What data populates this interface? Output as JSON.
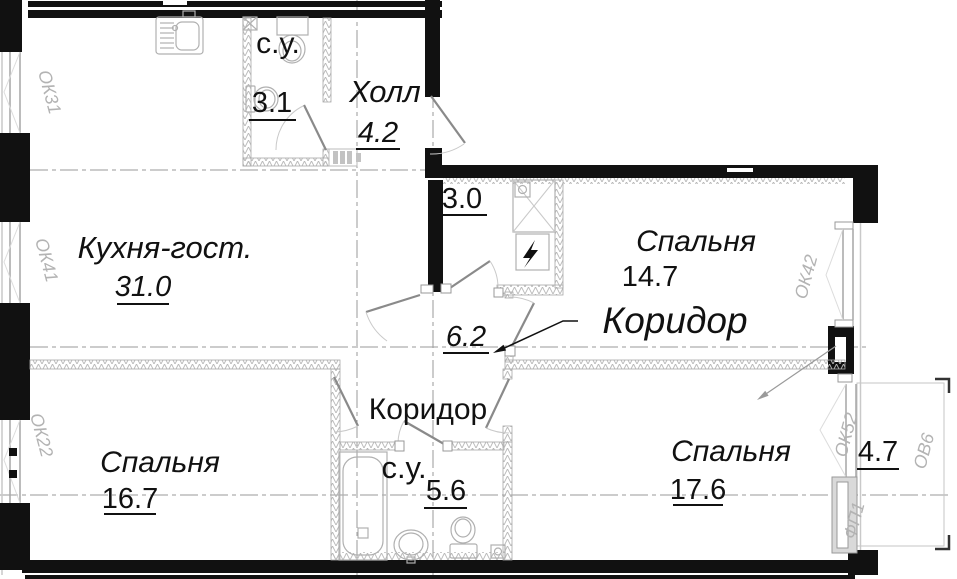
{
  "rooms": {
    "bath_top": {
      "name": "с.у.",
      "area": "3.1"
    },
    "hall": {
      "name": "Холл",
      "area": "4.2"
    },
    "kitchen_living": {
      "name": "Кухня-гост.",
      "area": "31.0"
    },
    "closet": {
      "area": "3.0"
    },
    "bedroom_top_right": {
      "name": "Спальня",
      "area": "14.7"
    },
    "corridor": {
      "name": "Коридор",
      "area": "6.2"
    },
    "corridor_lower": {
      "name": "Коридор"
    },
    "bath_bottom": {
      "name": "с.у.",
      "area": "5.6"
    },
    "bedroom_bottom_left": {
      "name": "Спальня",
      "area": "16.7"
    },
    "bedroom_bottom_right": {
      "name": "Спальня",
      "area": "17.6"
    },
    "balcony": {
      "area": "4.7"
    }
  },
  "marks": {
    "window_left_top": "ОК31",
    "window_left_middle": "ОК41",
    "window_left_bottom": "ОК22",
    "window_right": "ОК42",
    "balcony_door": "ОК52",
    "balcony_vent": "ОВ6",
    "facade_panel": "ФП1"
  },
  "colors": {
    "wall": "#111111",
    "glass": "#ababab",
    "partition_hatch": "#b8b8b8",
    "axis": "#9a9a9a",
    "mark_label": "#b3b3b3",
    "text": "#111111"
  }
}
